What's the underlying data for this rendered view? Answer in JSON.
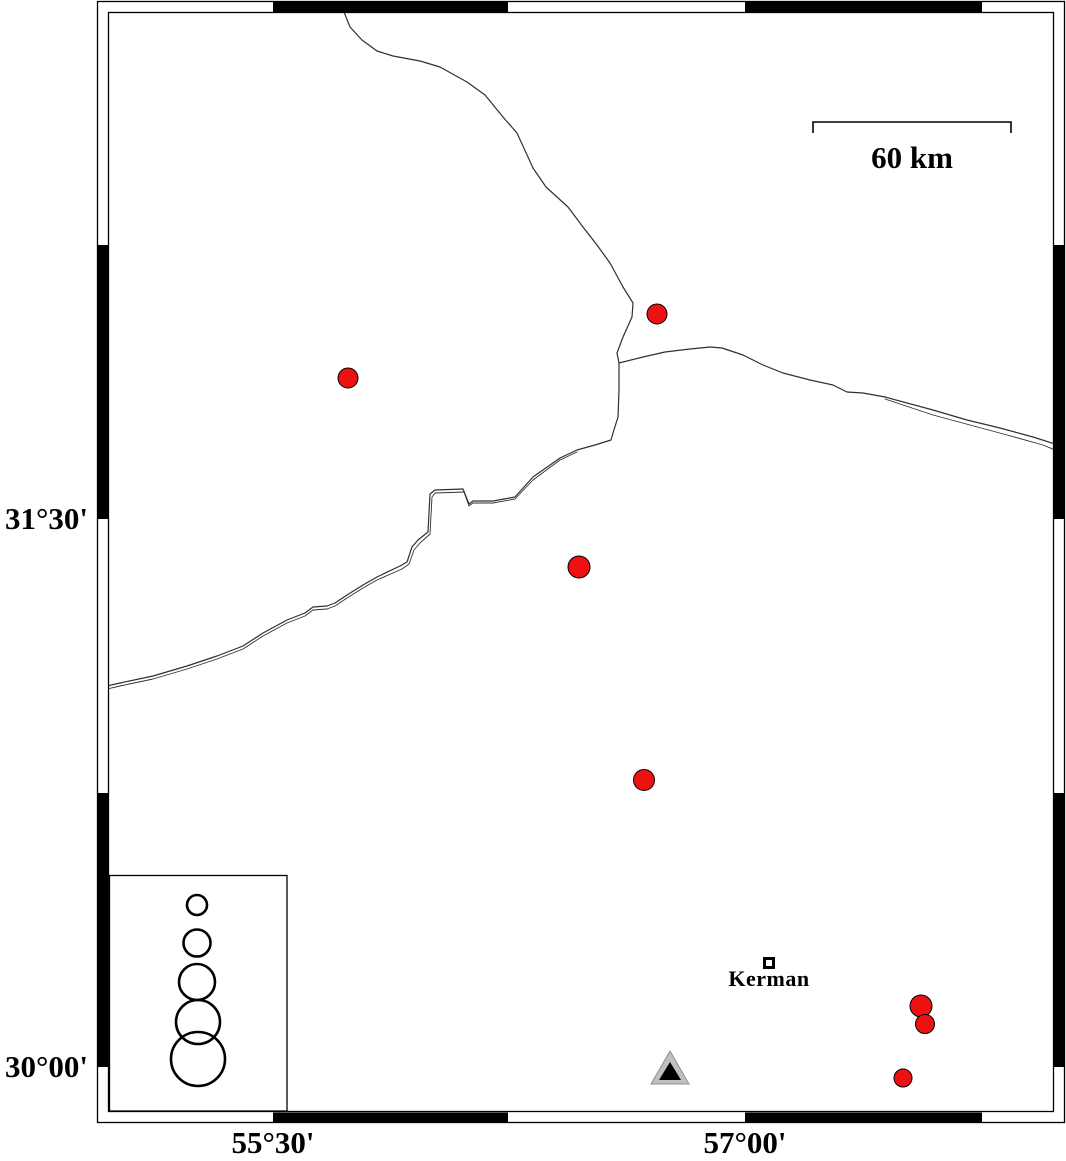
{
  "frame": {
    "lat_labels": [
      {
        "text": "31°30'"
      },
      {
        "text": "30°00'"
      }
    ],
    "lon_labels": [
      {
        "text": "55°30'"
      },
      {
        "text": "57°00'"
      }
    ]
  },
  "scale_bar": {
    "label": "60 km",
    "x1": 813,
    "x2": 1011,
    "y": 122,
    "drop": 11
  },
  "city": {
    "label": "Kerman",
    "square": {
      "cx": 769,
      "cy": 963,
      "size": 12,
      "border": 3
    }
  },
  "station": {
    "outer_points": "670,1051 651,1084 689,1084",
    "inner_points": "670,1062 659,1080 681,1080"
  },
  "markers": {
    "earthquakes": [
      {
        "x": 657,
        "y": 314,
        "r": 10
      },
      {
        "x": 348,
        "y": 378,
        "r": 10
      },
      {
        "x": 579,
        "y": 567,
        "r": 11
      },
      {
        "x": 644,
        "y": 780,
        "r": 10.5
      },
      {
        "x": 921,
        "y": 1006,
        "r": 11
      },
      {
        "x": 925,
        "y": 1024,
        "r": 9.5
      },
      {
        "x": 903,
        "y": 1078,
        "r": 9
      }
    ]
  },
  "legend": {
    "box": {
      "x": 109.5,
      "y": 875.5,
      "w": 177.5,
      "h": 235.5
    },
    "circles": [
      {
        "cx": 197,
        "cy": 905,
        "r": 10
      },
      {
        "cx": 197,
        "cy": 943,
        "r": 13.5
      },
      {
        "cx": 197,
        "cy": 982,
        "r": 18
      },
      {
        "cx": 198,
        "cy": 1022,
        "r": 22
      },
      {
        "cx": 198,
        "cy": 1059,
        "r": 27
      }
    ],
    "stroke_width": 2.6
  },
  "lines": [
    {
      "name": "fault-line-north",
      "width": 1.2,
      "points": [
        [
          344,
          12
        ],
        [
          350,
          27
        ],
        [
          362,
          40
        ],
        [
          377,
          51
        ],
        [
          393,
          56
        ],
        [
          420,
          61
        ],
        [
          440,
          67
        ],
        [
          467,
          82
        ],
        [
          485,
          95
        ],
        [
          503,
          117
        ],
        [
          517,
          133
        ],
        [
          533,
          168
        ],
        [
          546,
          187
        ],
        [
          568,
          207
        ],
        [
          583,
          227
        ],
        [
          597,
          245
        ],
        [
          610,
          263
        ],
        [
          623,
          287
        ],
        [
          633,
          303
        ],
        [
          632,
          317
        ],
        [
          623,
          337
        ],
        [
          617,
          353
        ],
        [
          619,
          363
        ]
      ]
    },
    {
      "name": "fault-line-east",
      "width": 1.2,
      "points": [
        [
          619,
          363
        ],
        [
          643,
          357
        ],
        [
          665,
          352
        ],
        [
          690,
          349
        ],
        [
          710,
          347
        ],
        [
          722,
          348
        ],
        [
          743,
          355
        ],
        [
          763,
          365
        ],
        [
          783,
          373
        ],
        [
          810,
          380
        ],
        [
          833,
          385
        ],
        [
          847,
          392
        ],
        [
          863,
          393
        ],
        [
          885,
          397
        ],
        [
          933,
          410
        ],
        [
          967,
          420
        ],
        [
          1000,
          428
        ],
        [
          1033,
          437
        ],
        [
          1055,
          444
        ]
      ]
    },
    {
      "name": "fault-line-east-parallel",
      "width": 0.9,
      "points": [
        [
          885,
          399
        ],
        [
          897,
          403
        ],
        [
          933,
          415
        ],
        [
          970,
          425
        ],
        [
          1007,
          435
        ],
        [
          1043,
          445
        ],
        [
          1055,
          450
        ]
      ]
    },
    {
      "name": "fault-line-southwest",
      "width": 1.2,
      "points": [
        [
          619,
          363
        ],
        [
          619,
          390
        ],
        [
          618,
          417
        ],
        [
          613,
          433
        ],
        [
          611,
          440
        ],
        [
          595,
          445
        ],
        [
          577,
          450
        ],
        [
          560,
          458
        ],
        [
          533,
          477
        ],
        [
          515,
          497
        ],
        [
          493,
          501
        ],
        [
          473,
          501
        ],
        [
          469,
          504
        ],
        [
          463,
          489
        ],
        [
          435,
          490
        ],
        [
          430,
          494
        ],
        [
          428,
          532
        ],
        [
          418,
          540
        ],
        [
          412,
          547
        ],
        [
          407,
          562
        ],
        [
          400,
          566
        ],
        [
          377,
          577
        ],
        [
          363,
          585
        ],
        [
          347,
          595
        ],
        [
          335,
          603
        ],
        [
          327,
          606
        ],
        [
          313,
          607
        ],
        [
          305,
          613
        ],
        [
          287,
          620
        ],
        [
          263,
          633
        ],
        [
          243,
          646
        ],
        [
          217,
          656
        ],
        [
          187,
          666
        ],
        [
          153,
          676
        ],
        [
          120,
          683
        ],
        [
          107,
          686
        ]
      ]
    },
    {
      "name": "fault-line-southwest-parallel",
      "width": 0.9,
      "points": [
        [
          577,
          452
        ],
        [
          560,
          460
        ],
        [
          533,
          480
        ],
        [
          515,
          499
        ],
        [
          493,
          503
        ],
        [
          473,
          503
        ],
        [
          469,
          506
        ],
        [
          464,
          492
        ],
        [
          435,
          493
        ],
        [
          432,
          497
        ],
        [
          430,
          534
        ],
        [
          420,
          543
        ],
        [
          414,
          550
        ],
        [
          409,
          564
        ],
        [
          402,
          569
        ],
        [
          377,
          580
        ],
        [
          363,
          588
        ],
        [
          347,
          598
        ],
        [
          335,
          606
        ],
        [
          327,
          609
        ],
        [
          313,
          610
        ],
        [
          305,
          616
        ],
        [
          287,
          623
        ],
        [
          263,
          636
        ],
        [
          243,
          649
        ],
        [
          217,
          659
        ],
        [
          187,
          669
        ],
        [
          153,
          679
        ],
        [
          120,
          686
        ],
        [
          107,
          689
        ]
      ]
    }
  ],
  "colors": {
    "epicenter": "#ee1111",
    "marker_outline": "#000000",
    "line": "#303030",
    "frame": "#000000",
    "station_fill": "#c0c0c0",
    "station_edge": "#8f8f8f",
    "station_inner": "#000000"
  }
}
